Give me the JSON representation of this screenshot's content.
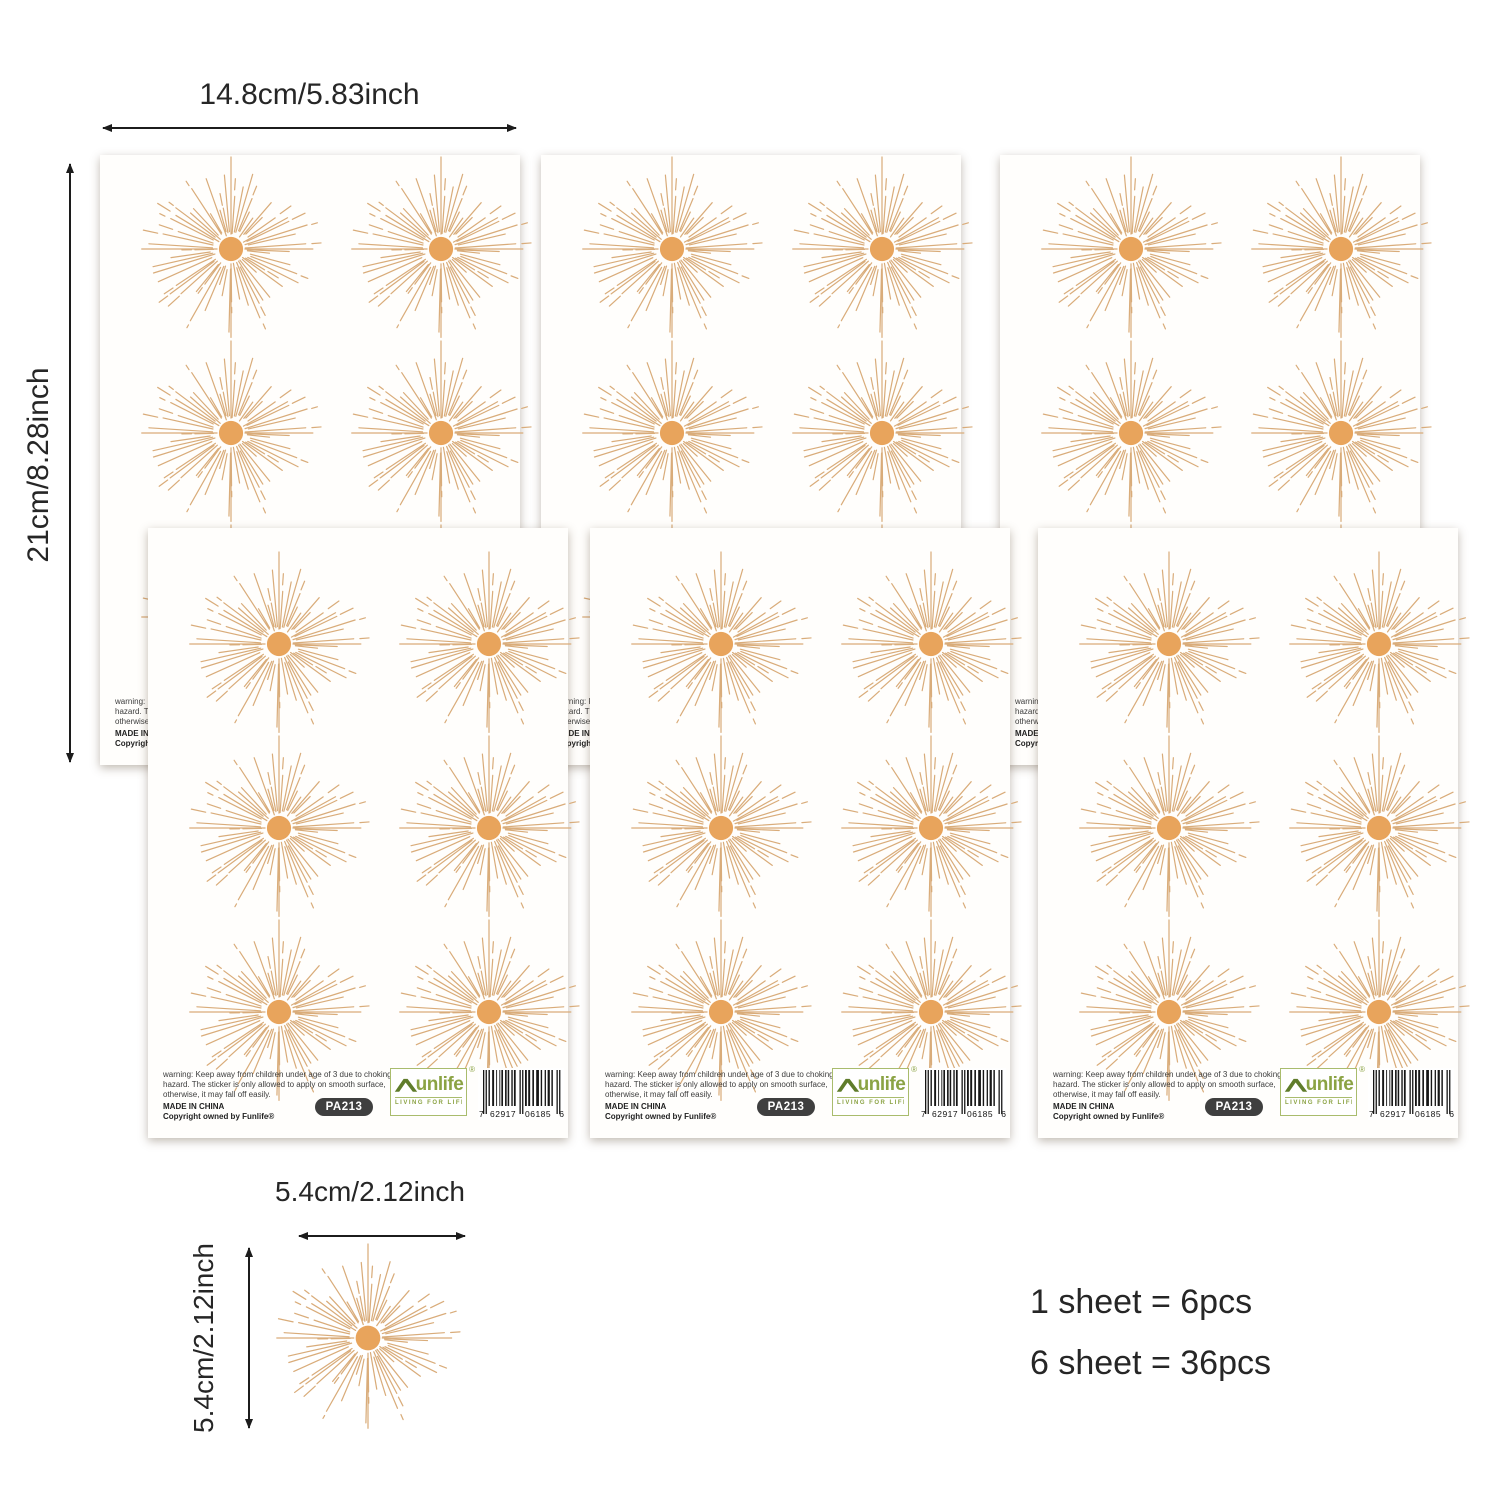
{
  "dimensions": {
    "sheet_width_label": "14.8cm/5.83inch",
    "sheet_height_label": "21cm/8.28inch",
    "sticker_width_label": "5.4cm/2.12inch",
    "sticker_height_label": "5.4cm/2.12inch"
  },
  "counts": {
    "line1": "1 sheet = 6pcs",
    "line2": "6 sheet = 36pcs"
  },
  "sheet": {
    "warning_line1": "warning: Keep away from children under age of 3 due to choking",
    "warning_line2": "hazard. The sticker is only allowed to apply on smooth surface,",
    "warning_line3": "otherwise, it may fall off easily.",
    "made_in": "MADE IN CHINA",
    "copyright": "Copyright owned by Funlife®",
    "sku": "PA213",
    "brand": {
      "name": "unlife",
      "tagline": "LIVING FOR LIFE",
      "registered": "®"
    },
    "barcode_digits": [
      "7",
      "62917",
      "06185",
      "6"
    ]
  },
  "colors": {
    "sun_center": "#e8a45c",
    "sun_rays": "#d9ac7a",
    "brand_green": "#8ba344",
    "brand_green_dark": "#5f7c2b",
    "badge_bg": "#3f3f3f",
    "text_dark": "#262626"
  }
}
